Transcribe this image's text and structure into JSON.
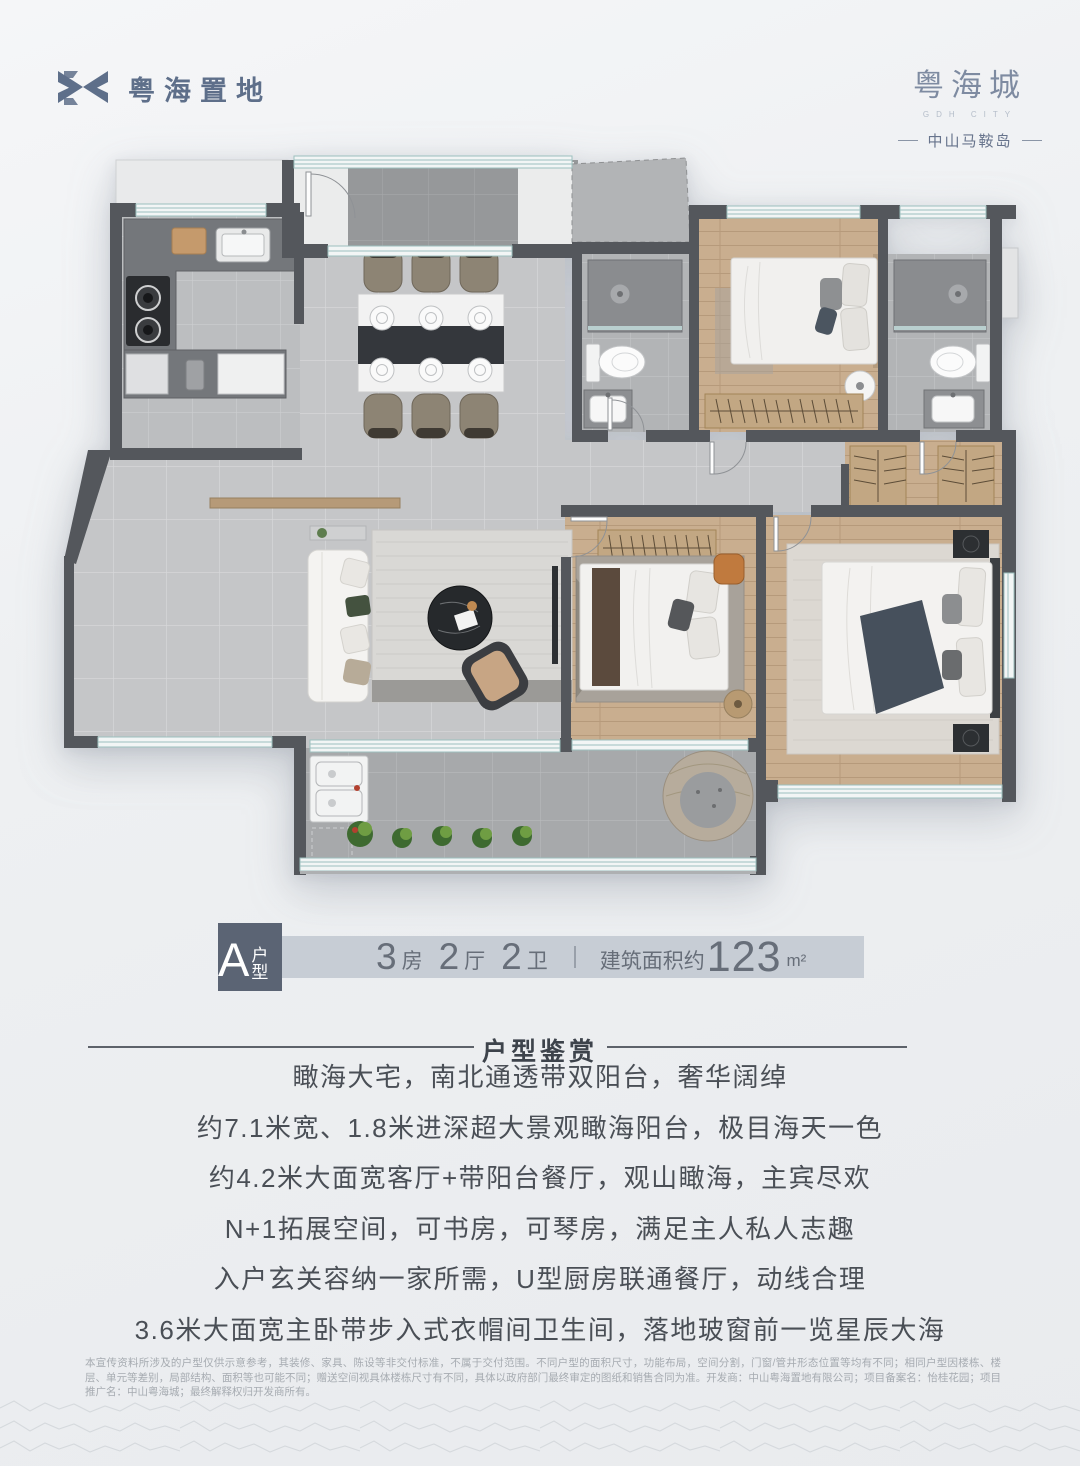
{
  "colors": {
    "brand": "#5e6f8a",
    "badge_bg": "#5b6474",
    "bar_bg": "#c7cdd5"
  },
  "brand": {
    "left_logo_text": "粤海置地",
    "right_logo_title": "粤海城",
    "right_logo_subtitle": "GDH CITY",
    "right_logo_location_text": "中山马鞍岛"
  },
  "unit_bar": {
    "badge_letter": "A",
    "badge_suffix": "户型",
    "specs": [
      {
        "num": "3",
        "unit": "房"
      },
      {
        "num": "2",
        "unit": "厅"
      },
      {
        "num": "2",
        "unit": "卫"
      }
    ],
    "area_prefix": "建筑面积约",
    "area_value": "123",
    "area_unit": "m²"
  },
  "section": {
    "title": "户型鉴赏",
    "lines": [
      "瞰海大宅，南北通透带双阳台，奢华阔绰",
      "约7.1米宽、1.8米进深超大景观瞰海阳台，极目海天一色",
      "约4.2米大面宽客厅+带阳台餐厅，观山瞰海，主宾尽欢",
      "N+1拓展空间，可书房，可琴房，满足主人私人志趣",
      "入户玄关容纳一家所需，U型厨房联通餐厅，动线合理",
      "3.6米大面宽主卧带步入式衣帽间卫生间，落地玻窗前一览星辰大海"
    ]
  },
  "disclaimer": {
    "line1": "本宣传资料所涉及的户型仅供示意参考，其装修、家具、陈设等非交付标准，不属于交付范围。不同户型的面积尺寸，功能布局，空间分割，门窗/管井形态位置等均有不同；相同户型因楼栋、楼层、单元等差别，局部结构、面积等也可能不同；赠送空间视具体楼",
    "line2": "栋尺寸有不同，具体以政府部门最终审定的图纸和销售合同为准。开发商：中山粤海置地有限公司；项目备案名：怡桂花园；项目推广名：中山粤海城；最终解释权归开发商所有。"
  }
}
